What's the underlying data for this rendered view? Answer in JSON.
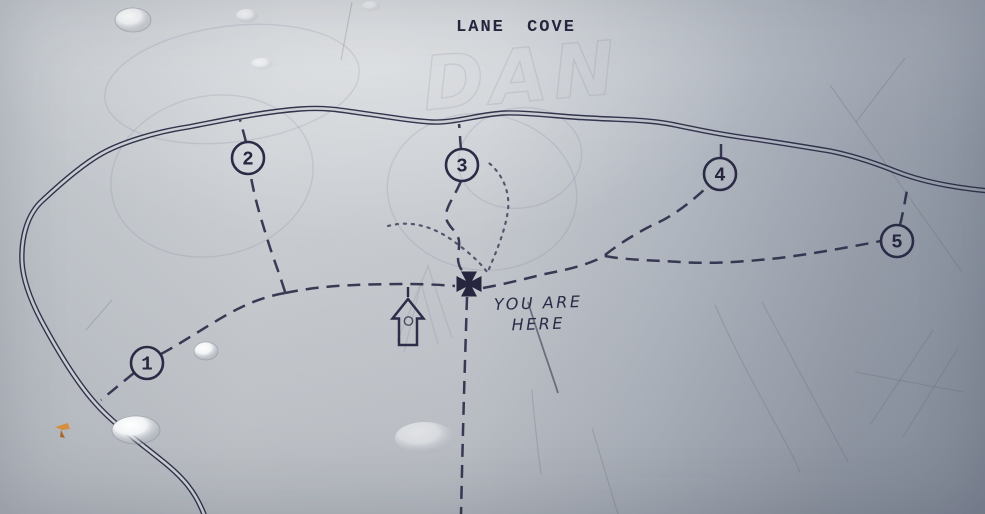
{
  "photo": {
    "kind": "trail map sign photograph",
    "ink_color": "#2d2d49",
    "background_light": "#ccd0d4",
    "background_dark": "#8a92a0"
  },
  "map": {
    "title": "LANE COVE",
    "stations": [
      {
        "id": 1,
        "label": "1",
        "x": 147,
        "y": 363
      },
      {
        "id": 2,
        "label": "2",
        "x": 248,
        "y": 158
      },
      {
        "id": 3,
        "label": "3",
        "x": 462,
        "y": 165
      },
      {
        "id": 4,
        "label": "4",
        "x": 720,
        "y": 174
      },
      {
        "id": 5,
        "label": "5",
        "x": 897,
        "y": 241
      }
    ],
    "marker": {
      "symbol": "maltese-cross",
      "label_line1": "YOU ARE",
      "label_line2": "HERE"
    },
    "icons": [
      {
        "name": "maltese-cross-icon",
        "meaning": "you-are-here marker"
      },
      {
        "name": "up-arrow-icon",
        "meaning": "direction / entrance arrow"
      }
    ],
    "line_styles": {
      "solid_double_line": "boundary road / river",
      "dashed_line": "walking trail",
      "dotted_line": "short loop track"
    },
    "graffiti_text": "DAN"
  }
}
